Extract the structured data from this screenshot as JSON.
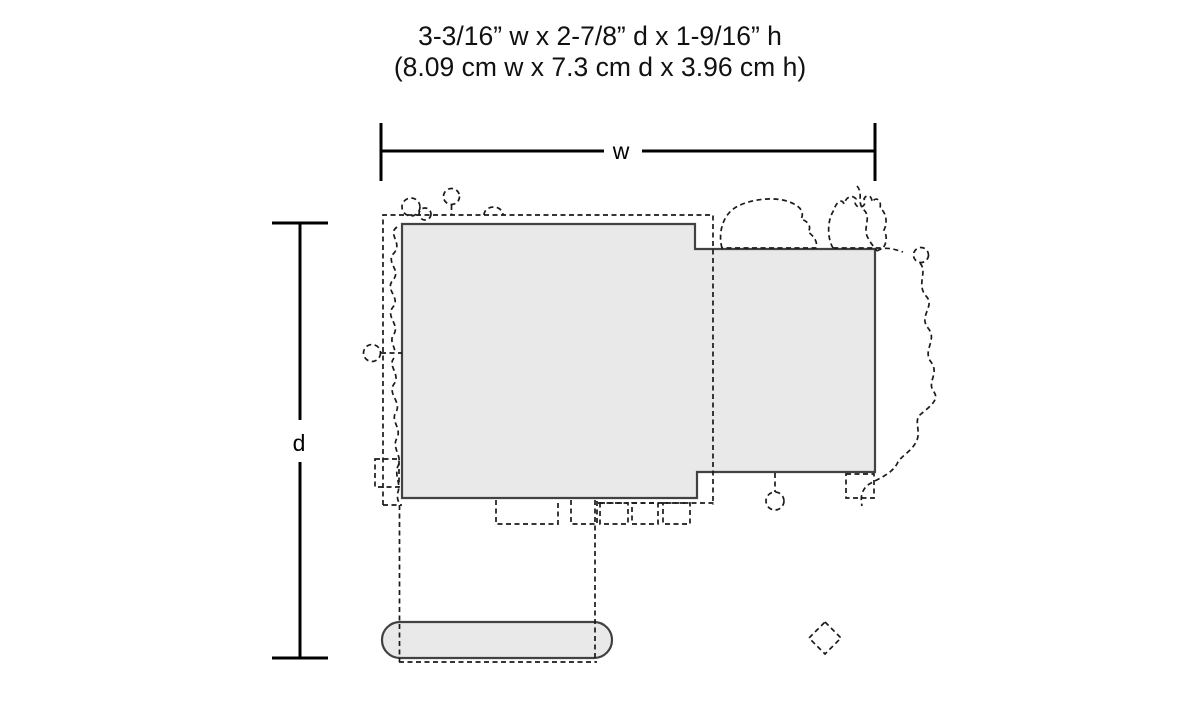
{
  "diagram": {
    "title": {
      "line1": "3-3/16” w x 2-7/8” d x 1-9/16” h",
      "line2": "(8.09 cm w x 7.3 cm d x 3.96 cm h)"
    },
    "dimensions": {
      "width_label": "w",
      "depth_label": "d",
      "imperial": {
        "width": "3-3/16”",
        "depth": "2-7/8”",
        "height": "1-9/16”"
      },
      "metric": {
        "width": "8.09 cm",
        "depth": "7.3 cm",
        "height": "3.96 cm"
      }
    },
    "colors": {
      "background": "#ffffff",
      "footprint_fill": "#e9e9e9",
      "footprint_outline": "#424242",
      "dimension_line": "#000000",
      "dashed_detail": "#1a1a1a",
      "text": "#111111"
    }
  }
}
